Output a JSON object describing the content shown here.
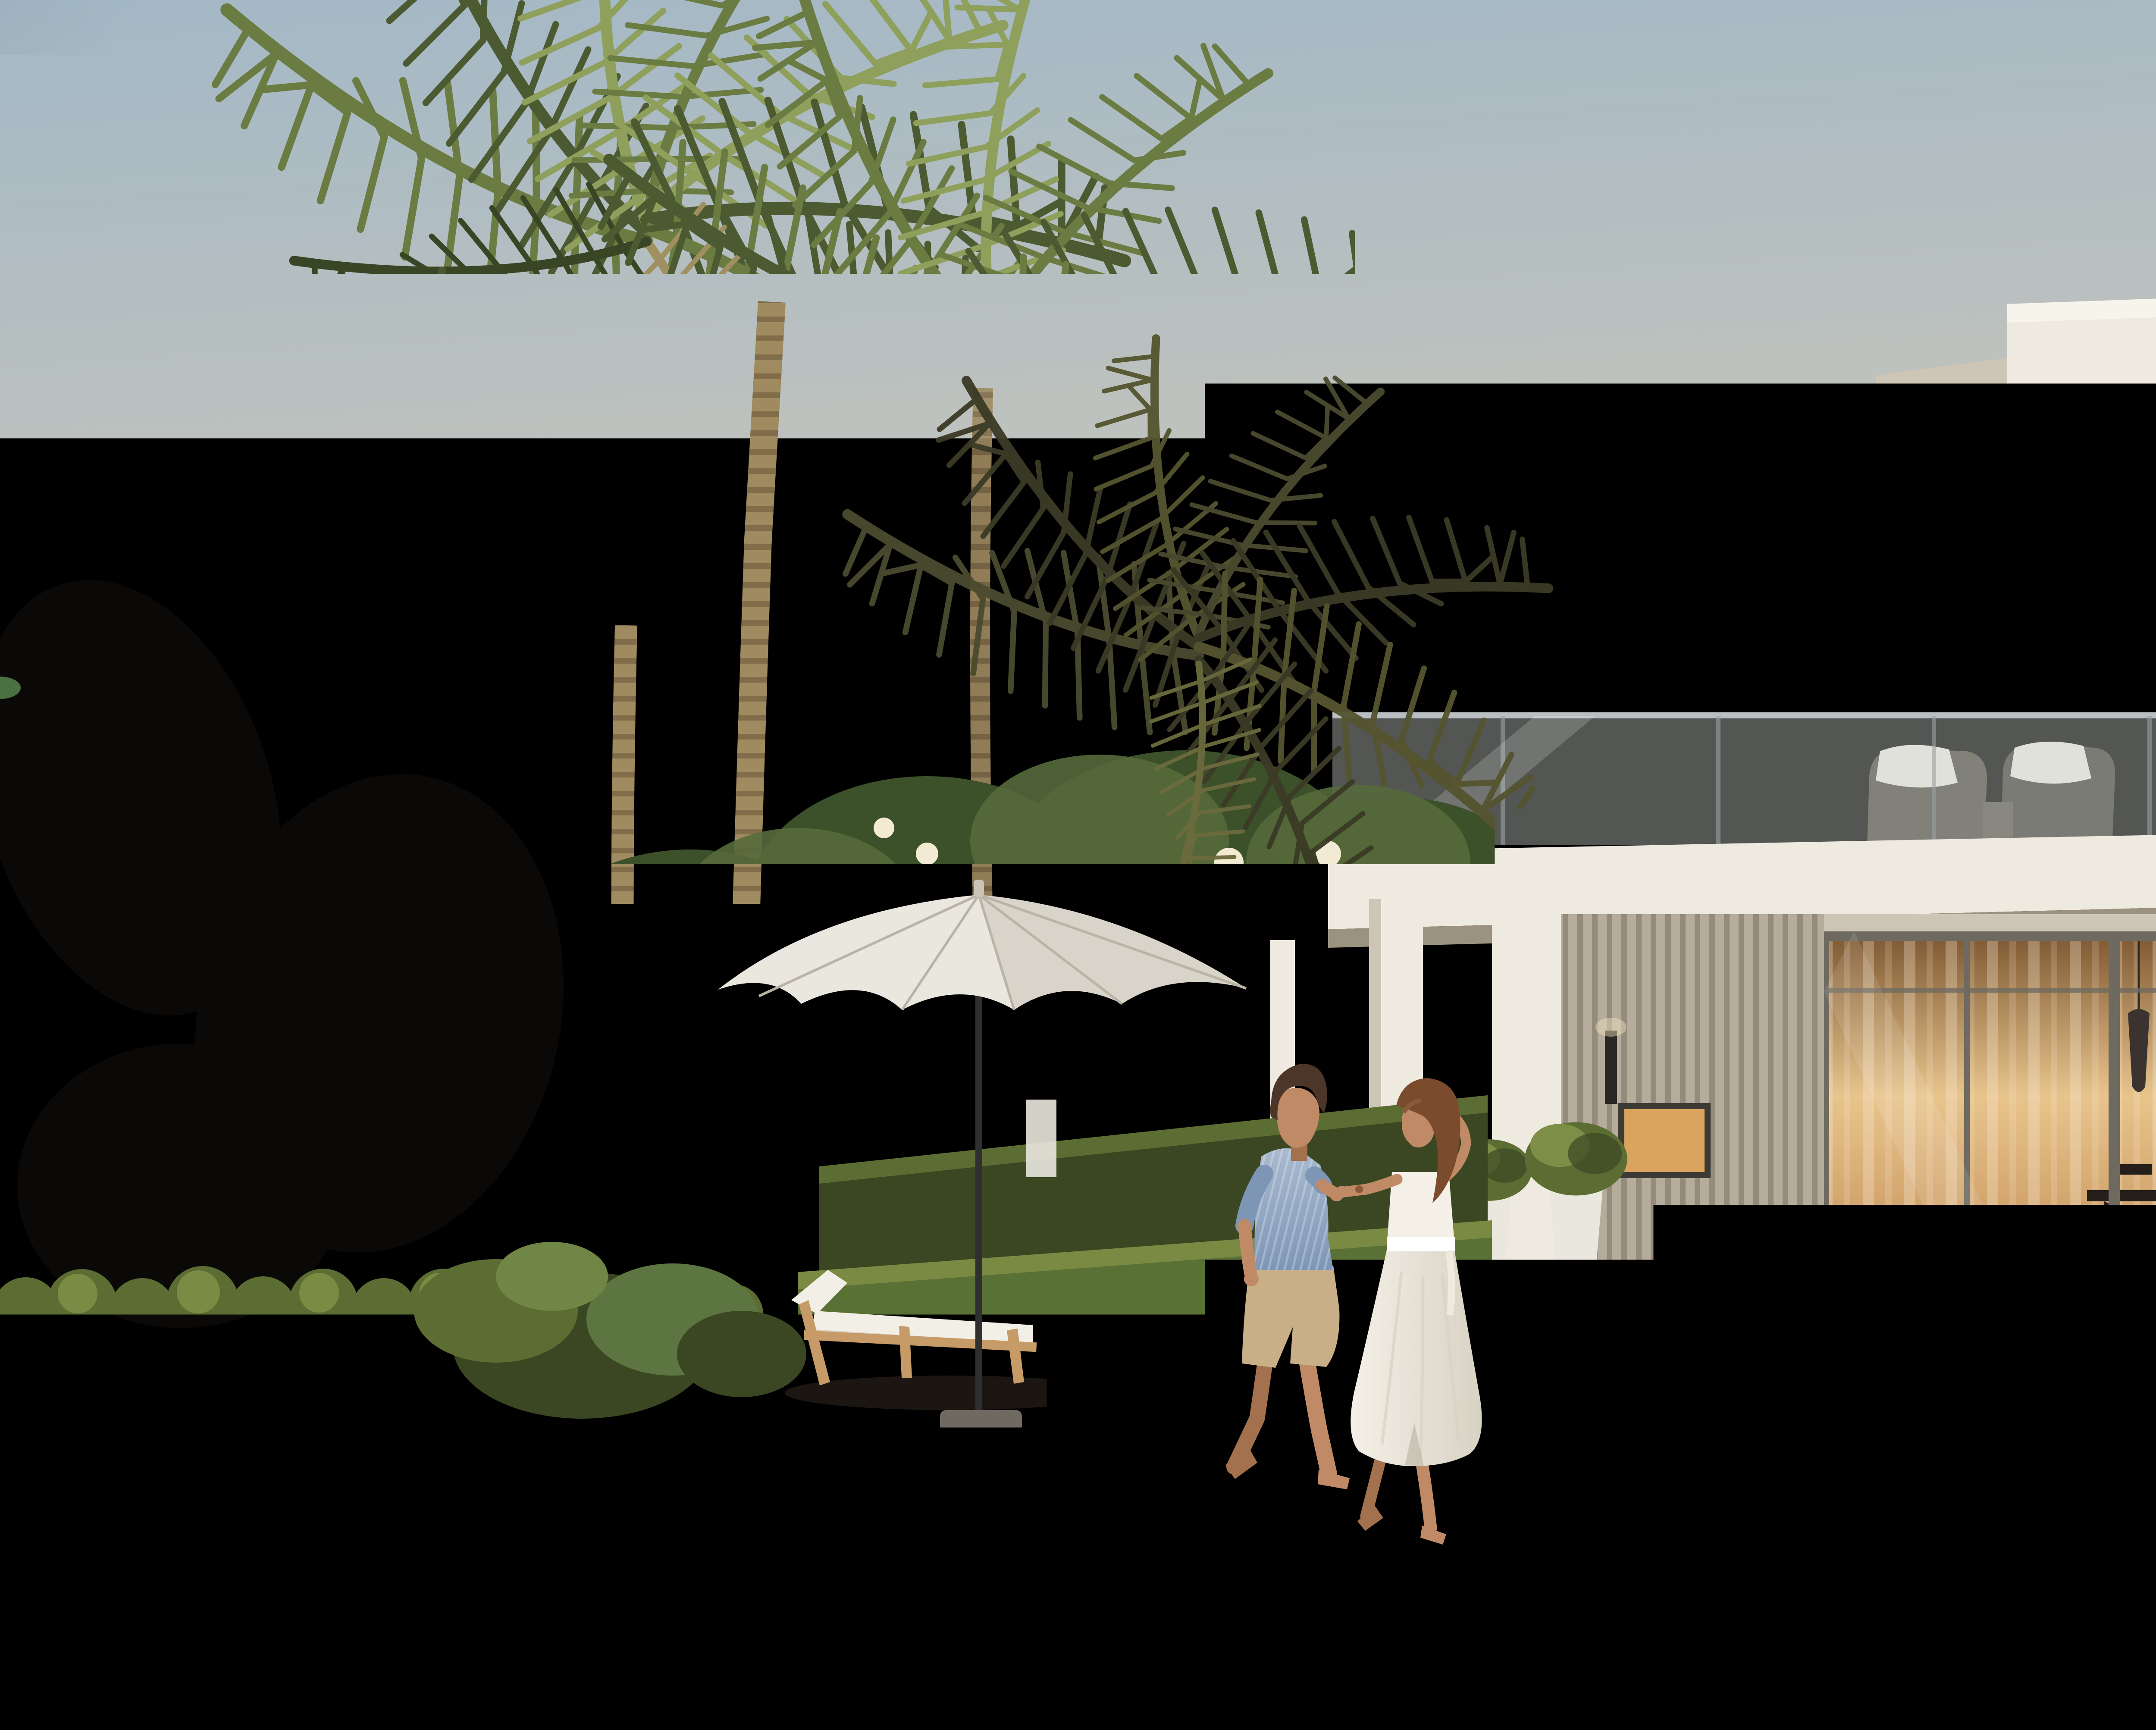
{
  "meta": {
    "kind": "architectural_exterior_render",
    "time_of_day": "sunset",
    "setting": "beachfront luxury villa with private pool"
  },
  "scene": {
    "objects": [
      {
        "name": "sky",
        "description": "clear gradient sky, cool blue upper-left fading to warm peach at horizon"
      },
      {
        "name": "main-villa",
        "description": "modern two-storey white villa, flat roof slabs, floor-to-ceiling glazing with warm interior lighting, glass balcony"
      },
      {
        "name": "neighbor-villa",
        "description": "white side wall of neighbouring villa on the left with tall narrow windows"
      },
      {
        "name": "background-buildings",
        "description": "low sunset-lit buildings seen between the villas"
      },
      {
        "name": "infinity-pool",
        "description": "light turquoise infinity-edge pool in front of the villa"
      },
      {
        "name": "wooden-deck",
        "description": "dark timber pool deck and lighter timber garden deck"
      },
      {
        "name": "beach-sand",
        "description": "golden sand foreground"
      },
      {
        "name": "sea-surf",
        "description": "teal water with white foam entering bottom-left corner"
      },
      {
        "name": "parasol",
        "description": "white garden parasol with black pole"
      },
      {
        "name": "sun-loungers",
        "description": "two timber sun loungers with white cushions under the parasol"
      },
      {
        "name": "pool-loungers",
        "description": "two white sculptural chaise longues on the pool terrace"
      },
      {
        "name": "man",
        "description": "barefoot man in striped blue shirt and beige shorts walking right, holding hands"
      },
      {
        "name": "woman",
        "description": "barefoot woman in white midi dress looking back over her shoulder"
      },
      {
        "name": "palm-trees",
        "description": "tall coconut palms left and right, large fronds overhanging the top edge"
      },
      {
        "name": "pink-flowering-trees",
        "description": "pink blossom trees at left wall and far right"
      },
      {
        "name": "frangipani-garden",
        "description": "frangipani trees with white flowers, hedges, monstera and lawn"
      },
      {
        "name": "balcony-furniture",
        "description": "wicker armchairs with white cushions, potted plant, dark chair and colourful painting behind glass"
      },
      {
        "name": "interior-details",
        "description": "pendant lamps, dining table, staircase and backlit bookshelf behind the sliding glass doors"
      }
    ]
  },
  "palette": {
    "sky_top": "#a3b8c6",
    "sky_mid": "#c9c6ba",
    "sky_warm": "#ecd9bb",
    "sky_horizon": "#f6e2c0",
    "sunset_glow": "#f7ddaa",
    "sea_deep": "#2e5a60",
    "sea_light": "#7fa8a5",
    "foam": "#f4f6f0",
    "sand_light": "#dcc79c",
    "sand_mid": "#cbb187",
    "sand_shadow": "#ab9370",
    "wet_sand": "#e9dcc0",
    "deck_dark": "#6b4b30",
    "deck_dark_line": "#4a3220",
    "deck_light": "#b0916c",
    "deck_light_line": "#8f7252",
    "pool_face": "#a9d4dc",
    "pool_face_deep": "#6fa7b4",
    "pool_water": "#bfe1e3",
    "pool_water_deep": "#8ec4cd",
    "villa_white": "#efeae0",
    "villa_shadow": "#cdc5b6",
    "villa_dark": "#a89f8f",
    "fascia_under": "#9b937f",
    "glass_warm": "#e8c48d",
    "glass_amber": "#c08a52",
    "glass_deep": "#7c5630",
    "glass_sky": "#cfd5d3",
    "balustrade": "#c7cdc9",
    "mullion": "#6e6a60",
    "slat_light": "#b5ac9b",
    "slat_dark": "#948b7a",
    "interior_dark": "#3a332b",
    "stair_light": "#ecd9ae",
    "shelf_warm": "#b98752",
    "hedge": "#5c6d33",
    "hedge_lit": "#7d8e46",
    "hedge_dark": "#3a4722",
    "grass": "#5a7135",
    "grass_dark": "#3e5524",
    "leaf_lit": "#8ea05b",
    "leaf_mid": "#6b7c42",
    "leaf_dark": "#4c5a31",
    "leaf_deepest": "#394626",
    "leaf_dry": "#a08f5f",
    "leaf_teal": "#33493a",
    "canopy_dark": "#3c5029",
    "canopy_mid": "#55693b",
    "flower_white": "#f2ead3",
    "pink_bloom": "#b2636c",
    "pink_bloom_lit": "#cf8b8b",
    "trunk_light": "#a08a60",
    "trunk_dark": "#7c6846",
    "trunk_spike": "#8d7459",
    "trunk_spike_dark": "#5d4a3c",
    "branch_gold": "#c49a5e",
    "left_wall": "#cfc8bb",
    "left_wall_shade": "#b3ac9f",
    "window_warm": "#daa45e",
    "window_dark": "#27221c",
    "bg_orange": "#d89a66",
    "bg_cream": "#e7d9c2",
    "bg_white": "#ded5c5",
    "bg_window": "#5f574b",
    "lavender": "#9c8aa4",
    "umbrella_top": "#eae7df",
    "umbrella_shade": "#c9c4b7",
    "pole_dark": "#2f2f2f",
    "wood_frame": "#c79b68",
    "cushion": "#f2efe7",
    "cushion_shade": "#d9d3c5",
    "skin": "#c08a66",
    "skin_shade": "#a4714f",
    "hair_man": "#4b3629",
    "hair_woman": "#7b4b2e",
    "shirt_blue": "#7e96b6",
    "shirt_blue_light": "#a9bacf",
    "shorts_khaki": "#c9af87",
    "dress_white": "#f4f0e7",
    "dress_shade": "#d8d2c4",
    "sconce_dark": "#2b2722",
    "planter_white": "#eae7de",
    "stone_step": "#d9cfba"
  }
}
